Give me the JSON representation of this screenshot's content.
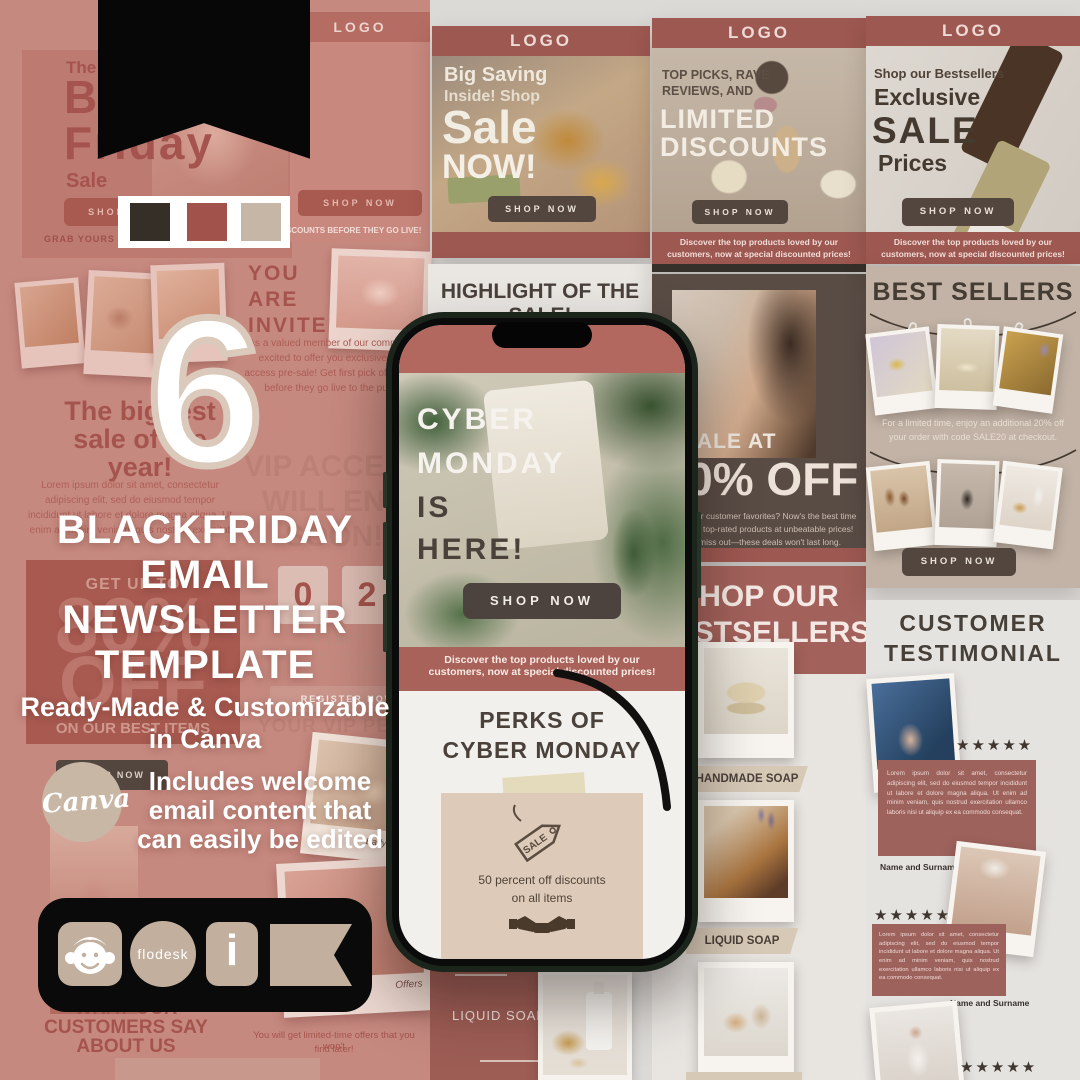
{
  "swatches": {
    "dark": "#352f28",
    "mauve": "#a1524a",
    "beige": "#c6b6a6"
  },
  "overlay": {
    "count": "6",
    "title": [
      "BLACKFRIDAY",
      "EMAIL",
      "NEWSLETTER",
      "TEMPLATE"
    ],
    "subtitle": [
      "Ready-Made & Customizable",
      "in Canva"
    ],
    "note": [
      "Includes welcome",
      "email content that",
      "can easily be edited"
    ],
    "canva": "Canva"
  },
  "platform_bar": {
    "flodesk": "flodesk",
    "i": "i"
  },
  "left": {
    "logo": "LOGO",
    "the": "The",
    "black": "Black-",
    "friday": "Friday",
    "sale": "Sale",
    "shop_now": "SHOP NOW",
    "grab": "GRAB YOURS W",
    "golive": "DISCOUNTS BEFORE THEY GO LIVE!",
    "invited": [
      "YOU",
      "ARE",
      "INVITED!"
    ],
    "invited_body": "As a valued member of our community, excited to offer you exclusive early access pre-sale! Get first pick of our best before they go live to the public.",
    "biggest": [
      "The biggest",
      "sale of the",
      "year!"
    ],
    "lorem": "Lorem ipsum dolor sit amet, consectetur adipiscing elit, sed do eiusmod tempor incididunt ut labore et dolore magna aliqua. Ut enim ad minim veniam, quis nostrud exercitat",
    "vip": [
      "VIP ACCESS",
      "WILL END",
      "SOON!"
    ],
    "digits": [
      "0",
      "2"
    ],
    "left_label": "S LEFT",
    "countdown_note": "Don't miss out—this is your chance to offers and save big on our popular products.",
    "get_up": "GET UP TO",
    "percent": "80%",
    "off": "OFF",
    "best_items": "ON OUR BEST ITEMS",
    "register": "REGISTER NOW",
    "vip_perks": "YOUR VIP PERKS",
    "early_access": "Early Access",
    "offers_label": "Offers",
    "what": [
      "WHAT OUR",
      "CUSTOMERS SAY",
      "ABOUT US"
    ],
    "offers_note": [
      "You will get limited-time offers that you won't",
      "find later!"
    ]
  },
  "big_saving": {
    "logo": "LOGO",
    "l1": "Big Saving",
    "l2": "Inside! Shop",
    "l3": "Sale",
    "l4": "NOW!",
    "shop_now": "SHOP NOW"
  },
  "highlight": {
    "t1": "HIGHLIGHT OF THE",
    "t2": "SALE!"
  },
  "limited": {
    "logo": "LOGO",
    "i1": "TOP PICKS, RAVE",
    "i2": "REVIEWS, AND",
    "b1": "LIMITED",
    "b2": "DISCOUNTS",
    "shop_now": "SHOP NOW",
    "f1": "Discover the top products loved by our",
    "f2": "customers, now at special discounted prices!"
  },
  "exclusive": {
    "logo": "LOGO",
    "intro": "Shop our Bestsellers",
    "l1": "Exclusive",
    "l2": "SALE",
    "l3": "Prices",
    "shop_now": "SHOP NOW",
    "f1": "Discover the top products loved by our",
    "f2": "customers, now at special discounted prices!"
  },
  "sale50": {
    "label": "SALE AT",
    "percent": "50% OFF",
    "body": "Looking for customer favorites? Now's the best time to get our top-rated products at unbeatable prices! Don't miss out—these deals won't last long."
  },
  "bestcol": {
    "h1": "SHOP OUR",
    "h2": "BESTSELLERS",
    "tag1": "HANDMADE SOAP",
    "tag2": "LIQUID SOAP"
  },
  "bestsellers": {
    "title": "BEST SELLERS",
    "p1": "For a limited time, enjoy an additional 20% off",
    "p2": "your order with code SALE20 at checkout.",
    "shop_now": "SHOP NOW"
  },
  "testimonials": {
    "t1": "CUSTOMER",
    "t2": "TESTIMONIAL",
    "stars": "★★★★★",
    "quote": "Lorem ipsum dolor sit amet, consectetur adipiscing elit, sed do eiusmod tempor incididunt ut labore et dolore magna aliqua. Ut enim ad minim veniam, quis nostrud exercitation ullamco laboris nisi ut aliquip ex ea commodo consequat.",
    "name": "Name and Surname"
  },
  "liquid_panel": {
    "label": "LIQUID SOAP"
  },
  "phone": {
    "hero": [
      "CYBER",
      "MONDAY",
      "IS",
      "HERE!"
    ],
    "shop_now": "SHOP NOW",
    "banner": [
      "Discover the top products loved by our",
      "customers, now at special discounted prices!"
    ],
    "perks": [
      "PERKS OF",
      "CYBER MONDAY"
    ],
    "tag": "SALE",
    "card": [
      "50 percent off discounts",
      "on all items"
    ]
  }
}
